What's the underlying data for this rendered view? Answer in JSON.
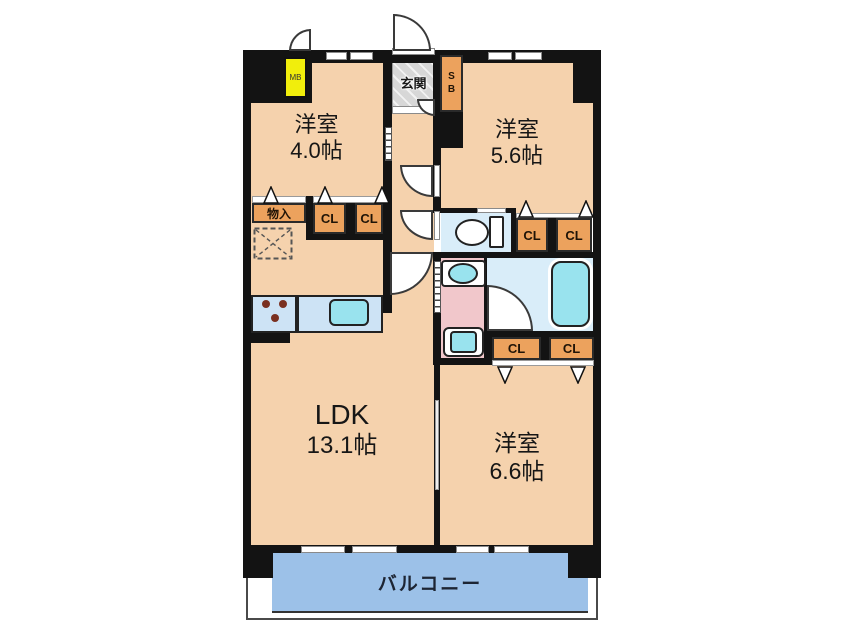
{
  "floorplan": {
    "rooms": {
      "bedroom_small": {
        "name": "洋室",
        "area": "4.0帖"
      },
      "bedroom_mid": {
        "name": "洋室",
        "area": "5.6帖"
      },
      "bedroom_large": {
        "name": "洋室",
        "area": "6.6帖"
      },
      "ldk": {
        "name": "LDK",
        "area": "13.1帖"
      },
      "balcony": {
        "name": "バルコニー"
      },
      "entrance": {
        "name": "玄関"
      }
    },
    "labels": {
      "closet": "CL",
      "storage": "物入",
      "shoe_box": "SB",
      "meter_box": "MB"
    },
    "colors": {
      "wall": "#131313",
      "room_fill": "#f5d2ad",
      "closet_fill": "#eca25d",
      "balcony_fill": "#9cc1e8",
      "water_blue": "#d9edf9",
      "fixture_cyan": "#99e3ee",
      "washroom_pink": "#f1c7cb",
      "entrance_gray": "#d7d7d7",
      "mb_yellow": "#f1ee0c",
      "counter_blue": "#cde3f5",
      "outline": "#2a2a2a",
      "balcony_text": "#1d2533"
    }
  }
}
